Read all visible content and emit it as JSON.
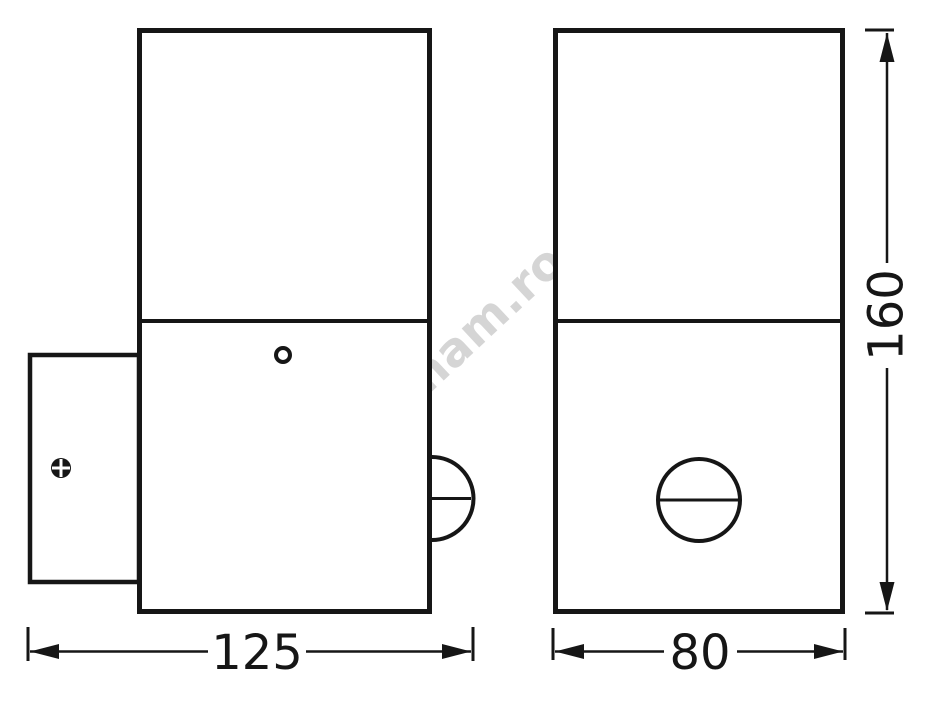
{
  "watermark": {
    "text": "luminam.ro"
  },
  "dimensions": {
    "depth": {
      "value": "125",
      "unit_note": "horizontal dimension under side view"
    },
    "width": {
      "value": "80",
      "unit_note": "horizontal dimension under front view"
    },
    "height": {
      "value": "160",
      "unit_note": "vertical dimension right of front view"
    }
  },
  "colors": {
    "line": "#161616",
    "watermark": "#d5d5d5",
    "background": "#ffffff"
  }
}
